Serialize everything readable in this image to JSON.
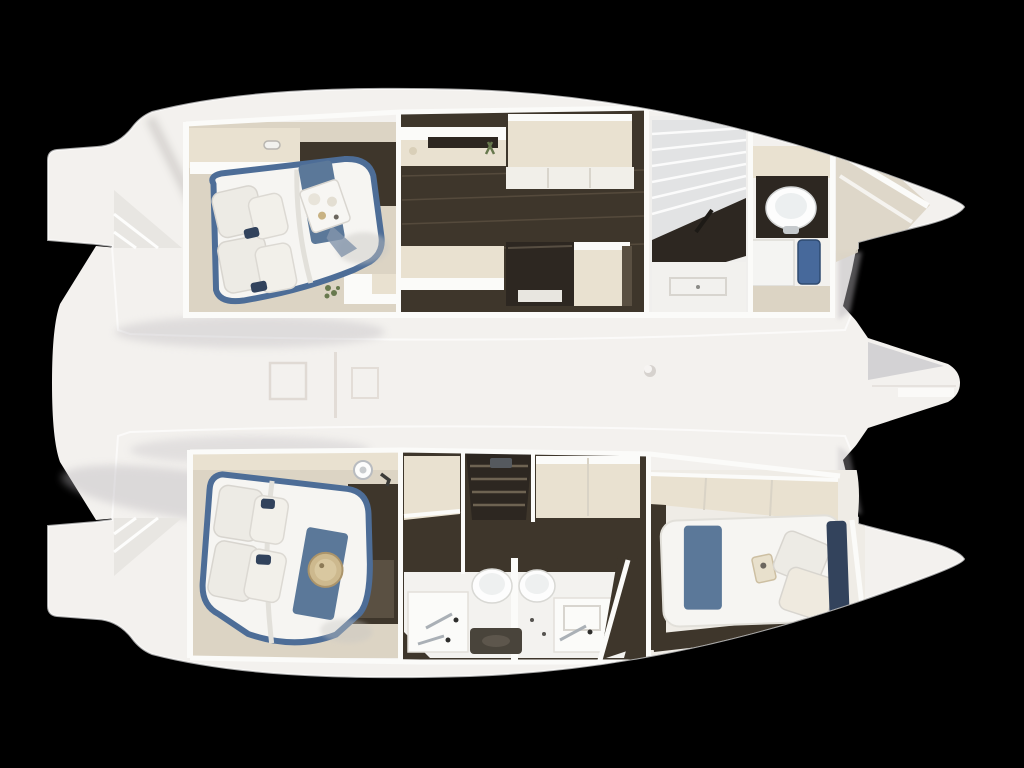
{
  "scene": {
    "subject": "catamaran-interior-floorplan-top-view-render",
    "background": "#000000",
    "hulls": 2
  },
  "palette": {
    "bg": "#000000",
    "hullWhite": "#f3f1ee",
    "hullBright": "#fbfaf8",
    "wall": "#fbfbf9",
    "cream": "#e9e1d0",
    "creamDark": "#d8cfbc",
    "floorBeige": "#dcd4c4",
    "wood": "#3e362b",
    "woodDark": "#2d2721",
    "woodLight": "#5a5042",
    "bedWhite": "#f6f5f2",
    "pillow": "#edebe5",
    "navy": "#31425c",
    "runnerBlue": "#5b7899",
    "trimBlue": "#4d6d97",
    "gold": "#c8b283",
    "green": "#68794e",
    "chrome": "#aab0b6",
    "toilet": "#fdfdfd",
    "tile": "#e2e3e4",
    "matBlue": "#47699b",
    "matDark": "#49443b",
    "grayShade": "#b9b6bb"
  },
  "regions": {
    "top_hull": [
      "stern-platform",
      "transom-steps",
      "owner-cabin-bed",
      "wardrobe",
      "galley-corridor",
      "vanity-desk",
      "side-cabinet",
      "settee",
      "nav-desk",
      "shower-room",
      "toilet-room",
      "bow-storage"
    ],
    "bottom_hull": [
      "stern-platform",
      "transom-steps",
      "guest-cabin-bed",
      "companionway-stairs",
      "twin-bathrooms",
      "double-sinks",
      "aft-guest-cabin",
      "bow-storage"
    ],
    "deck": [
      "bridge-deck",
      "deck-hatches",
      "mast-step",
      "bowsprit"
    ]
  }
}
